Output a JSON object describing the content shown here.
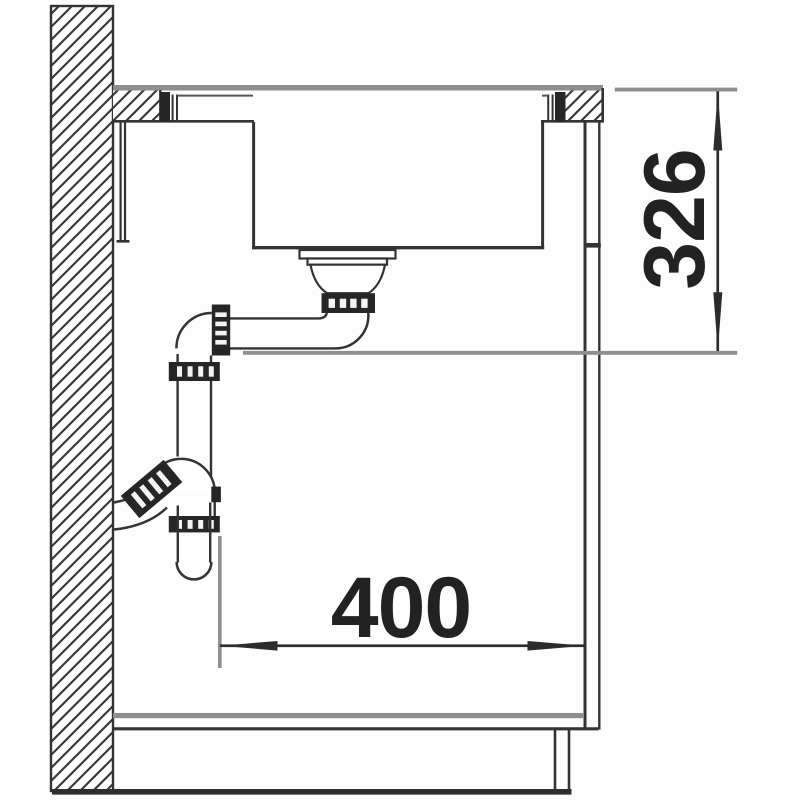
{
  "dimensions": {
    "height_label": "326",
    "width_label": "400"
  },
  "colors": {
    "ink": "#333333",
    "dark_fill": "#262626",
    "gray": "#8e8e8e",
    "text": "#222222",
    "background": "#fdfdfd"
  }
}
